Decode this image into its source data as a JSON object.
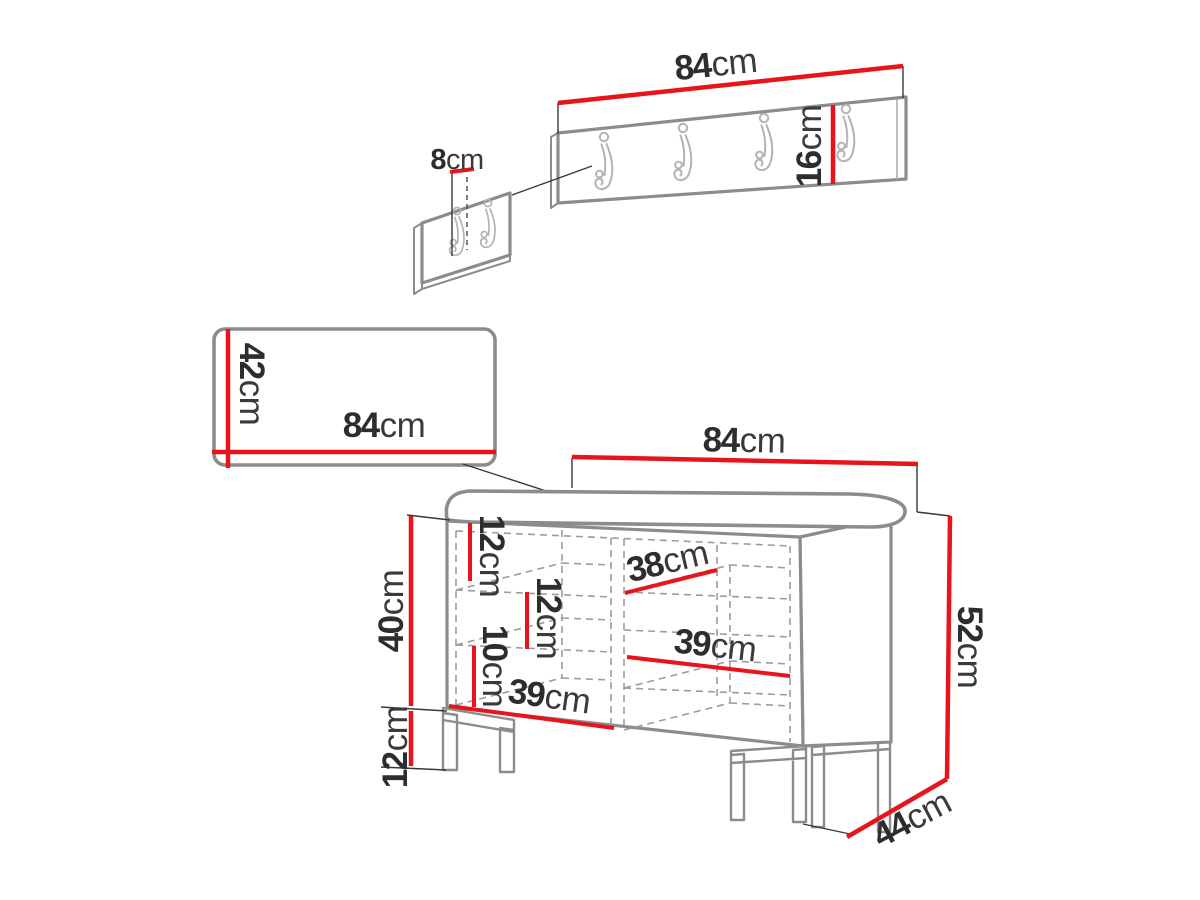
{
  "diagram": {
    "title": "hallway furniture set dimension drawing",
    "unit": "cm",
    "coat_rack": {
      "hook_count": 4
    },
    "hook_detail": {
      "hook_count": 2
    },
    "colors": {
      "dimension_red": "#e8141b",
      "furniture_outline_gray": "#8c8c8c",
      "hook_gray": "#b3b3b3",
      "hidden_line_gray": "#9d9d9d",
      "text_dark": "#2d2d2d",
      "background": "#ffffff"
    }
  },
  "dims": {
    "coat_rack_width": {
      "value": "84",
      "unit": "cm"
    },
    "coat_rack_height": {
      "value": "16",
      "unit": "cm"
    },
    "hook_spacing": {
      "value": "8",
      "unit": "cm"
    },
    "panel_height": {
      "value": "42",
      "unit": "cm"
    },
    "panel_width": {
      "value": "84",
      "unit": "cm"
    },
    "bench_width": {
      "value": "84",
      "unit": "cm"
    },
    "bench_total_height": {
      "value": "52",
      "unit": "cm"
    },
    "bench_depth": {
      "value": "44",
      "unit": "cm"
    },
    "bench_body_height": {
      "value": "40",
      "unit": "cm"
    },
    "bench_leg_height": {
      "value": "12",
      "unit": "cm"
    },
    "bench_top_gap": {
      "value": "12",
      "unit": "cm"
    },
    "bench_middle_gap": {
      "value": "12",
      "unit": "cm"
    },
    "bench_bottom_gap": {
      "value": "10",
      "unit": "cm"
    },
    "bench_shelf_depth": {
      "value": "38",
      "unit": "cm"
    },
    "bench_shelf_width_right": {
      "value": "39",
      "unit": "cm"
    },
    "bench_shelf_width_left": {
      "value": "39",
      "unit": "cm"
    }
  }
}
